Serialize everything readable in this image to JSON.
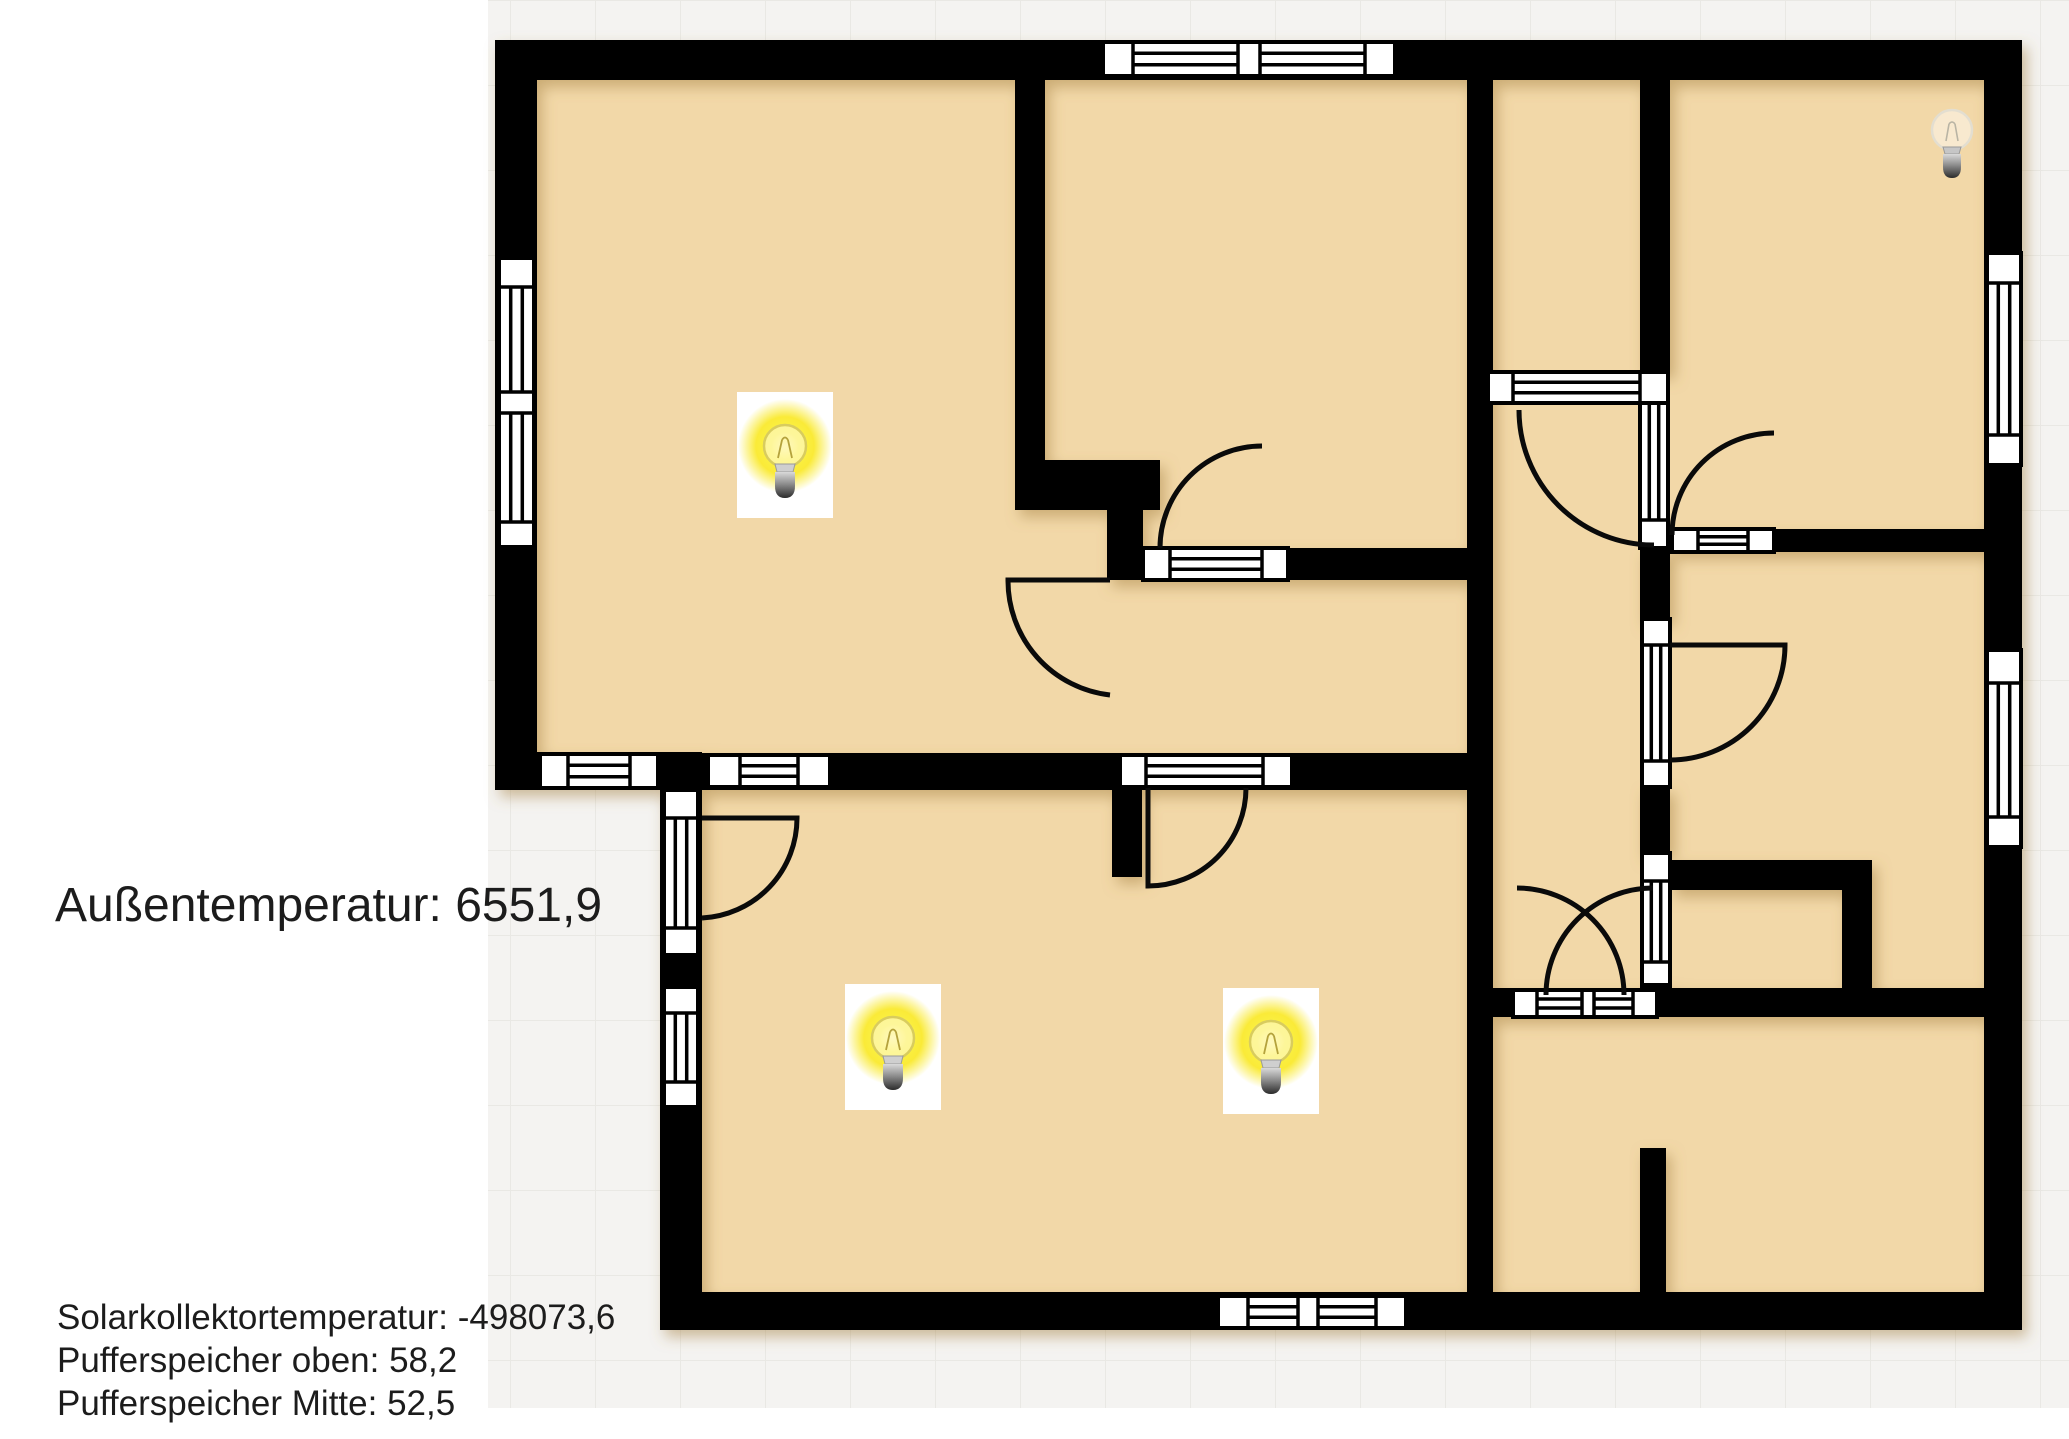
{
  "readings": {
    "outdoor": {
      "label": "Außentemperatur",
      "value": "6551,9"
    },
    "solar": {
      "label": "Solarkollektortemperatur",
      "value": "-498073,6"
    },
    "buffer_top": {
      "label": "Pufferspeicher oben",
      "value": "58,2"
    },
    "buffer_mid": {
      "label": "Pufferspeicher Mitte",
      "value": "52,5"
    }
  },
  "lights": [
    {
      "id": "light-top-left-room",
      "state": "on",
      "x": 785,
      "y": 448
    },
    {
      "id": "light-bottom-left-room",
      "state": "on",
      "x": 893,
      "y": 1040
    },
    {
      "id": "light-bottom-middle-room",
      "state": "on",
      "x": 1271,
      "y": 1044
    },
    {
      "id": "light-top-right-room",
      "state": "off",
      "x": 1952,
      "y": 132
    }
  ],
  "colors": {
    "floor": "#f2d8a8",
    "wall": "#000000",
    "window_frame": "#000000",
    "door_arc": "#0a0a0a",
    "glow": "#f9e822",
    "exterior": "#f4f3f1",
    "grid_line": "#e9e8e4",
    "text": "#1c1c1c"
  }
}
